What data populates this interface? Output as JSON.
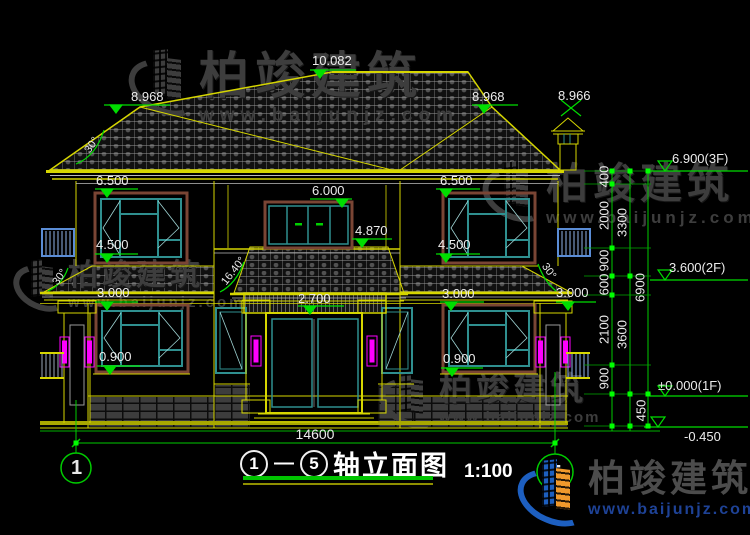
{
  "watermark": {
    "brand": "柏竣建筑",
    "url": "www.baijunjz.com"
  },
  "title": {
    "axis_from": "1",
    "dash": "—",
    "axis_to": "5",
    "name": "轴立面图",
    "scale": "1:100"
  },
  "axis_bubbles": {
    "left": "1",
    "right": "5"
  },
  "dims": {
    "total_width": "14600",
    "levels": {
      "ridge": "10.082",
      "hip_left": "8.968",
      "hip_right": "8.968",
      "chimney": "8.966",
      "w2_top_left": "6.500",
      "door2_top": "6.000",
      "w2_top_right": "6.500",
      "porch_eave": "4.870",
      "w2_sill_left": "4.500",
      "w2_sill_right": "4.500",
      "w1_top_left": "3.000",
      "w1_top_right": "3.000",
      "w1_top_far_right": "3.000",
      "door_top": "2.700",
      "w1_sill_left": "0.900",
      "w1_sill_right": "0.900"
    },
    "floor_levels": {
      "f3": "6.900(3F)",
      "f2": "3.600(2F)",
      "f1": "±0.000(1F)",
      "ground": "-0.450"
    },
    "chain_inner": {
      "s400": "400",
      "s2000": "2000",
      "s900a": "900",
      "s600": "600",
      "s2100": "2100",
      "s900b": "900",
      "s450": "450"
    },
    "chain_mid": {
      "s3300": "3300",
      "s3600": "3600"
    },
    "chain_outer": {
      "s6900": "6900"
    },
    "angles": {
      "main_roof": "30°",
      "porch_left": "30°",
      "porch_center": "16.40°",
      "porch_right": "30°"
    }
  }
}
